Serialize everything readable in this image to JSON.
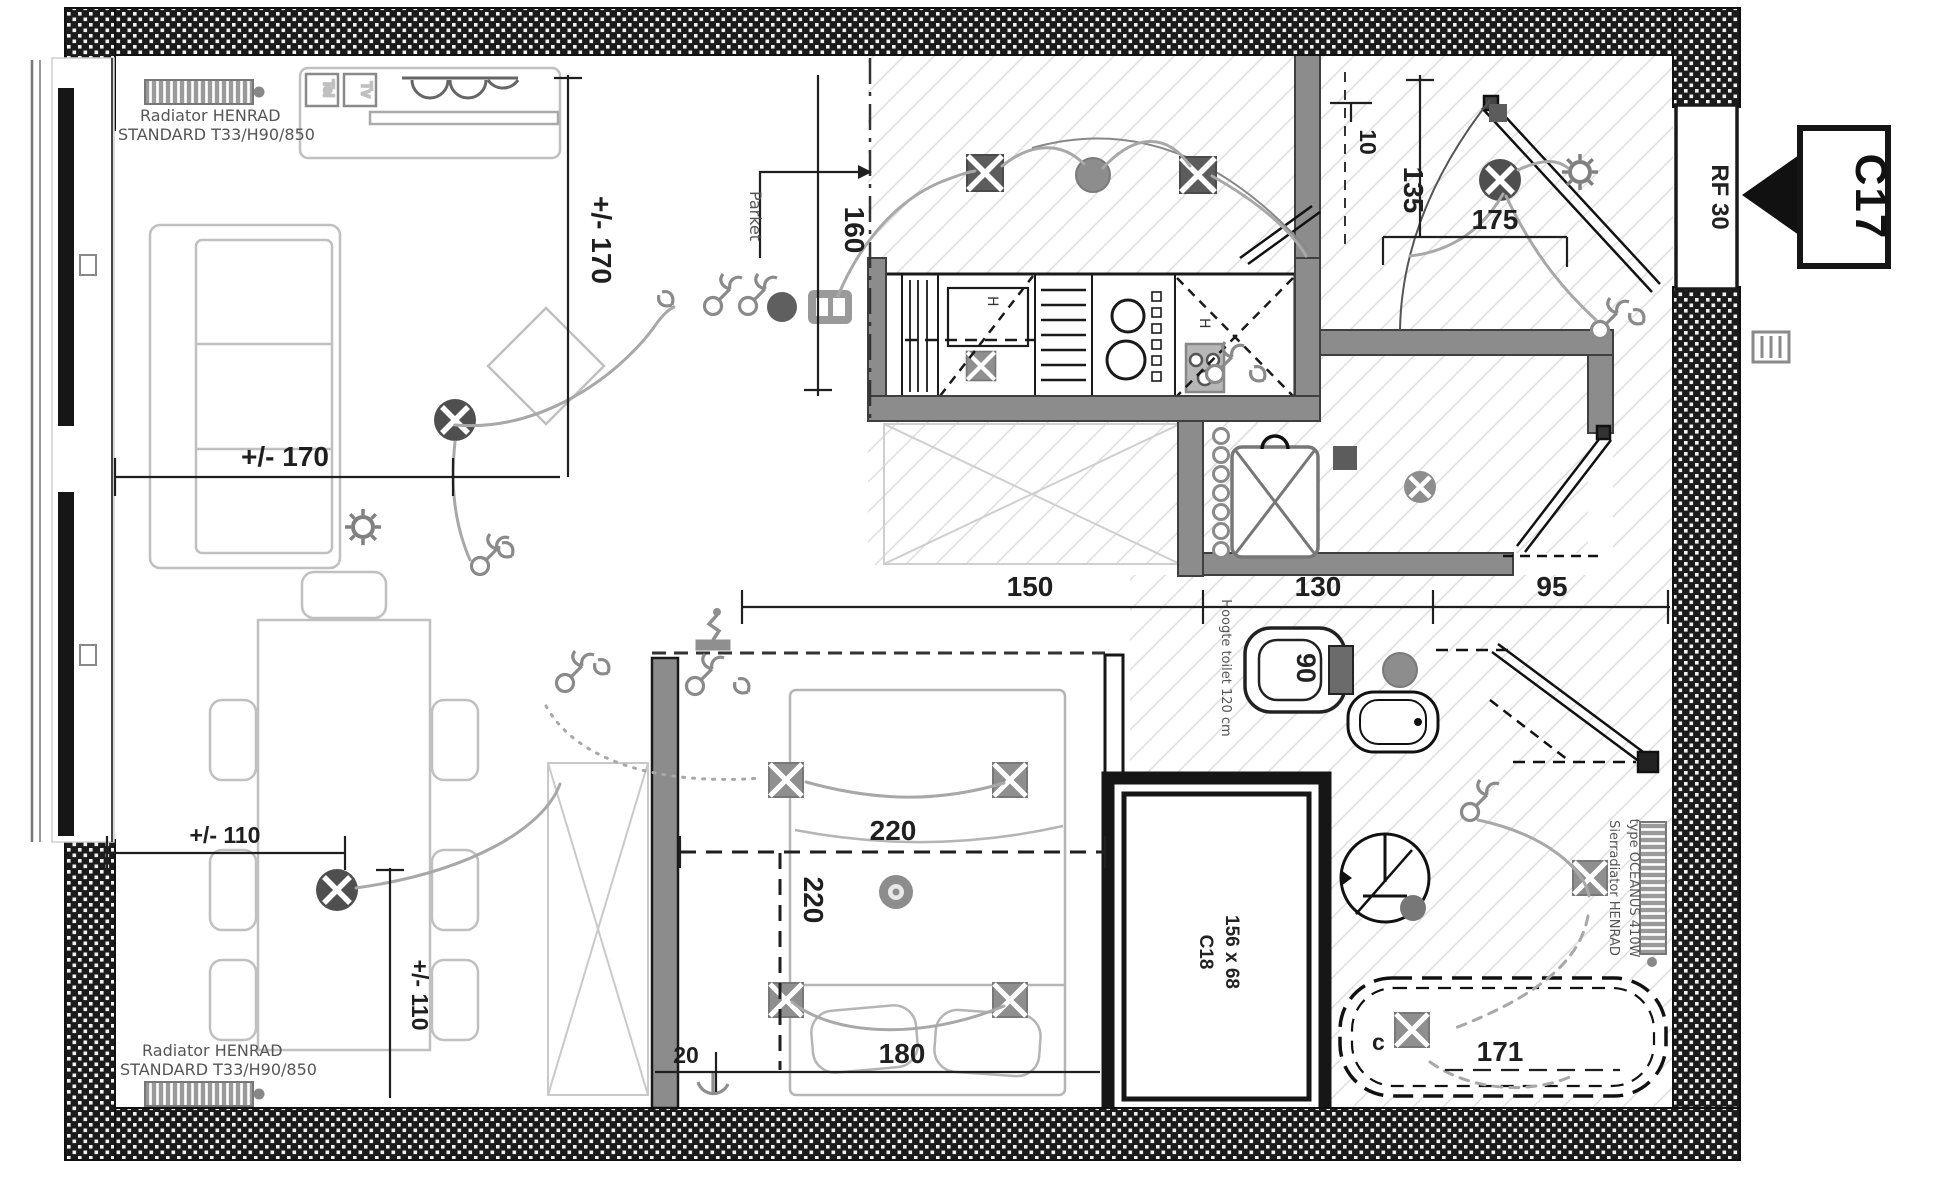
{
  "labels": {
    "unit": "C17",
    "door_rating": "RF 30",
    "shaft_name": "C18",
    "shaft_size": "156 x 68",
    "floor_note": "Parket",
    "toilet_note": "Hoogte toilet 120 cm",
    "tub_circuit": "c",
    "radiator_top": {
      "l1": "Radiator HENRAD",
      "l2": "STANDARD T33/H90/850"
    },
    "radiator_bottom": {
      "l1": "Radiator HENRAD",
      "l2": "STANDARD T33/H90/850"
    },
    "sierradiator": {
      "l1": "Sierradiator HENRAD",
      "l2": "type OCEANUS 410W"
    },
    "media_outlets": {
      "a": "Tel",
      "b": "Tv"
    },
    "unit_marks": {
      "a": "H",
      "b": "H"
    }
  },
  "dimensions": {
    "living_width": "+/- 170",
    "living_height": "+/- 170",
    "kitchen_left": "160",
    "kitchen_run": "150",
    "toilet_run": "130",
    "corridor": "95",
    "hall_depth": "135",
    "hall_width": "175",
    "door_offset": "10",
    "bed_width": "220",
    "bed_length": "220",
    "bed_gap": "20",
    "bed_side": "180",
    "bath_length": "171",
    "wc_width": "90",
    "table_width": "+/- 110",
    "table_height": "+/- 110"
  },
  "colors": {
    "wall_hatch": "#1b1b1b",
    "interior_wall": "#8c8c8c",
    "wiring": "#a8a8a8",
    "symbol_gray": "#8f8f8f",
    "line": "#1f1f1f",
    "furniture": "#c0c0c0",
    "tile_line": "#dedede"
  }
}
